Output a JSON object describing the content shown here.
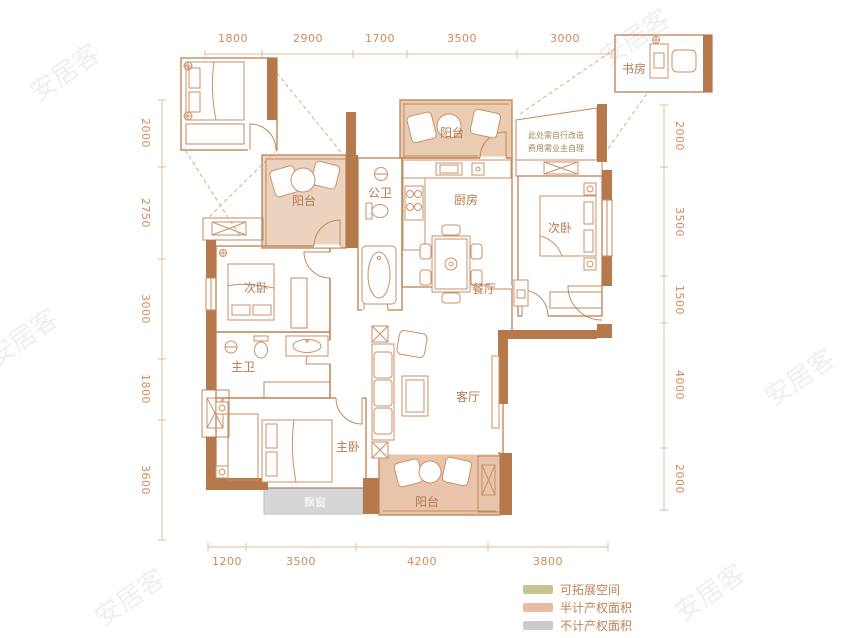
{
  "image_type": "apartment_floor_plan",
  "rooms": {
    "balcony_top": "阳台",
    "balcony_left": "阳台",
    "balcony_bottom": "阳台",
    "study": "书房",
    "public_bath": "公卫",
    "kitchen": "厨房",
    "bedroom_right": "次卧",
    "bedroom_left": "次卧",
    "dining": "餐厅",
    "master_bath": "主卫",
    "master_bedroom": "主卧",
    "living": "客厅",
    "bay_window": "飘窗"
  },
  "note": {
    "line1": "此处需自行改造",
    "line2": "费用需业主自理"
  },
  "dimensions": {
    "top": [
      "1800",
      "2900",
      "1700",
      "3500",
      "3000"
    ],
    "left": [
      "2000",
      "2750",
      "3000",
      "1800",
      "3600"
    ],
    "right": [
      "2000",
      "3500",
      "1500",
      "4000",
      "2000"
    ],
    "bottom": [
      "1200",
      "3500",
      "4200",
      "3800"
    ]
  },
  "legend": {
    "items": [
      {
        "label": "可拓展空间",
        "color": "#c9c48f"
      },
      {
        "label": "半计产权面积",
        "color": "#e6bca4"
      },
      {
        "label": "不计产权面积",
        "color": "#cbcbcb"
      }
    ]
  },
  "watermark": {
    "text": "安居客"
  },
  "colors": {
    "wall": "#b6794c",
    "thin_line": "#c08a5e",
    "dim_text": "#d08a5a",
    "room_label": "#b5794f",
    "balcony_fill": "#eacfb9",
    "expand_green": "#cdc795",
    "bay_gray": "#d5d6d8"
  }
}
